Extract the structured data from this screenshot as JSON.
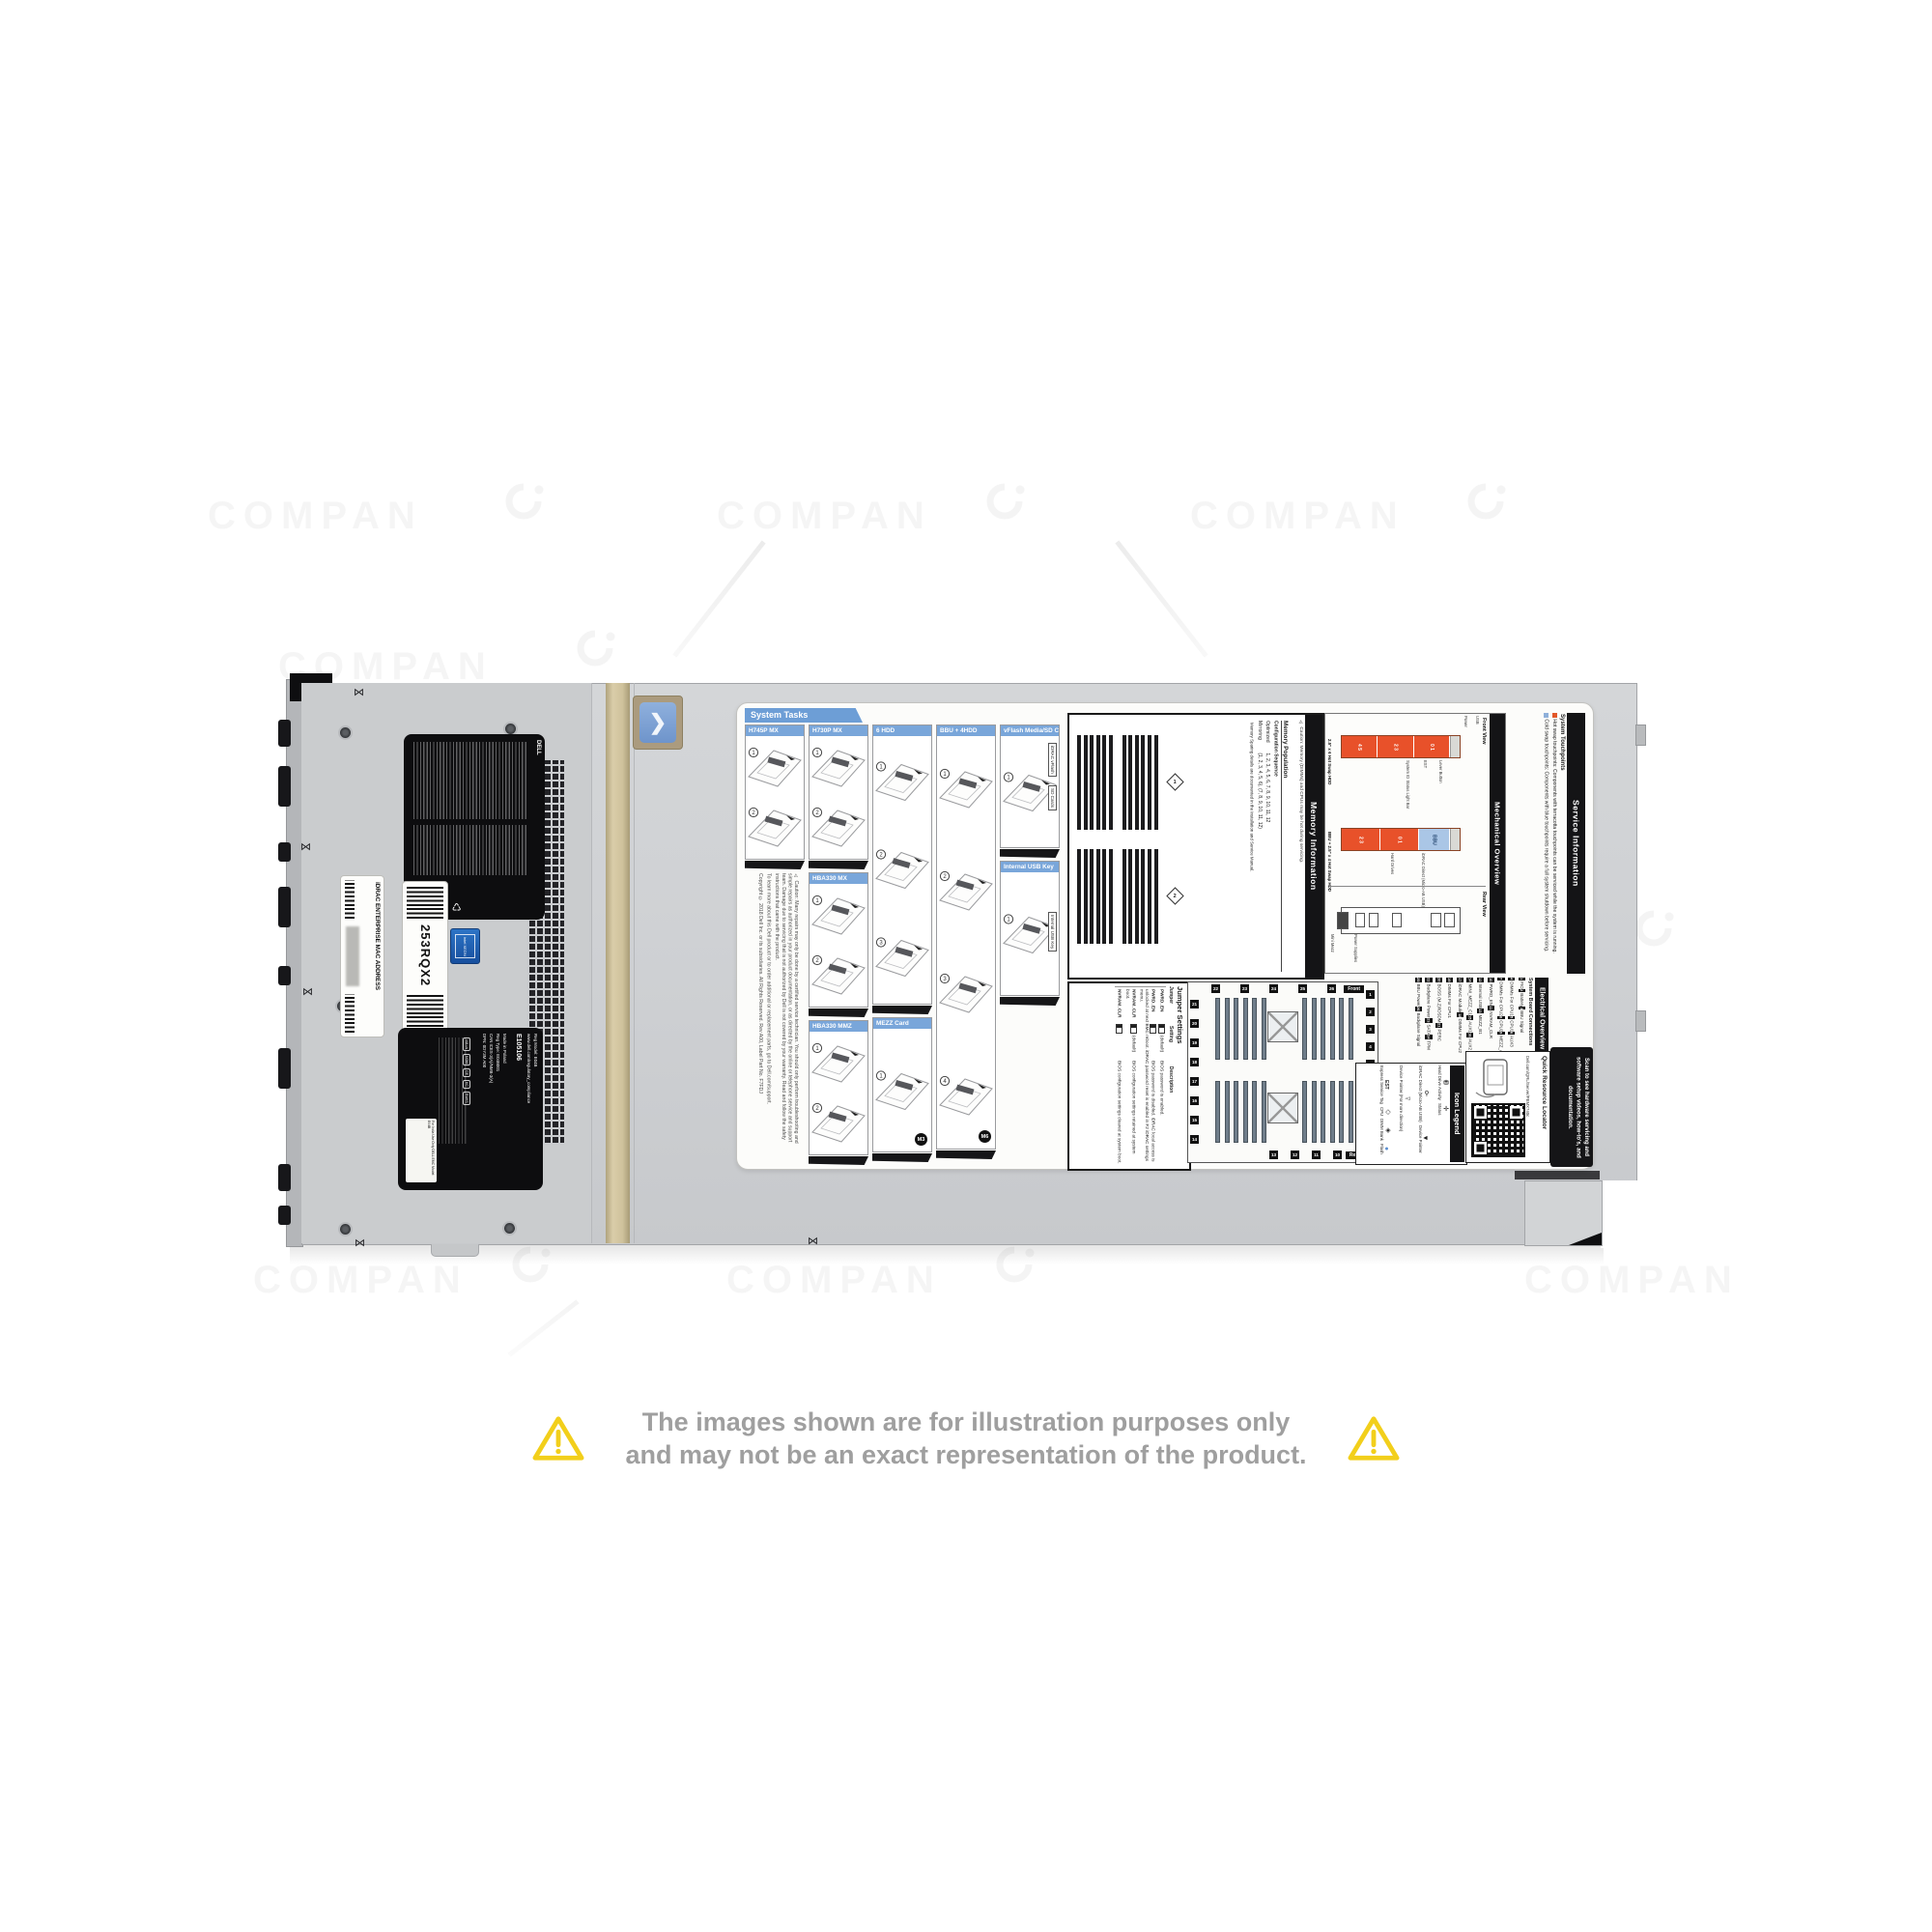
{
  "watermark": {
    "text": "COMPAN"
  },
  "disclaimer": {
    "line1": "The images shown are for illustration purposes only",
    "line2": "and may not be an exact representation of the product."
  },
  "chassis": {
    "service_tag_label": "253RQX2",
    "idrac_mac_label": "iDRAC ENTERPRISE MAC ADDRESS",
    "regulatory_label_top": {
      "brand": "DELL",
      "icons": [
        "warning-triangle",
        "weee-bin",
        "recycle"
      ]
    },
    "regulatory_label_bottom": {
      "reg_model": "Reg Model: E04B",
      "site": "www.dell.com/regulatory_compliance",
      "ul_file": "E105106",
      "made_in": "Made in Poland",
      "reg_type": "Reg Type: E04B001",
      "ices": "CAN ICES-3(A)/NMB-3(A)",
      "dpn": "DPN: 0DY3M A00",
      "india": "For India Use Only DELL EMC Model: E04B",
      "marks": [
        "cULus",
        "NOM",
        "CE",
        "KC",
        "RoHS"
      ]
    },
    "xeon_sticker": "intel XEON"
  },
  "label": {
    "system_tasks": {
      "title": "System Tasks",
      "columns": [
        {
          "panels": [
            {
              "title": "H745P MX",
              "steps": 2
            }
          ]
        },
        {
          "panels": [
            {
              "title": "H730P MX",
              "steps": 2
            },
            {
              "title": "HBA330 MX",
              "steps": 2
            },
            {
              "title": "HBA330 MMZ",
              "steps": 2
            }
          ]
        },
        {
          "panels": [
            {
              "title": "6 HDD",
              "steps": 3
            },
            {
              "title": "MEZZ Card",
              "steps": 1,
              "badge": "M3"
            }
          ]
        },
        {
          "panels": [
            {
              "title": "BBU + 4HDD",
              "steps": 4,
              "badge": "M6"
            }
          ]
        },
        {
          "panels": [
            {
              "title": "vFlash Media/SD Card",
              "steps": 1,
              "callouts": [
                "iDRAC vFlash",
                "SD Cards"
              ]
            },
            {
              "title": "Internal USB Key",
              "steps": 1,
              "callouts": [
                "Internal USB Key"
              ]
            }
          ]
        }
      ],
      "caution": "⚠ Caution: Many repairs may only be done by a certified service technician. You should only perform troubleshooting and simple repairs as authorized in your product documentation, or as directed by the online or telephone service and support team. Damage due to servicing that is not authorized by Dell is not covered by your warranty. Read and follow the safety instructions that came with the product.",
      "learn_more": "To learn more about this Dell product or to order additional or replacement parts, go to Dell.com/support.",
      "copyright": "Copyright © 2018 Dell Inc. or its subsidiaries. All Rights Reserved. Rev A00, Label Part No. F7FDJ"
    },
    "memory": {
      "title": "Memory Information",
      "caution": "⚠ Caution: Memory (DIMMs) and CPUs may be hot during servicing.",
      "population_title": "Memory Population",
      "col_configuration": "Configuration",
      "col_sequence": "Sequence",
      "rows": [
        {
          "configuration": "Optimized",
          "sequence": "1, 2, 3, 4, 5, 6, 7, 8, 9, 10, 11, 12"
        },
        {
          "configuration": "Mirroring",
          "sequence": "(1, 2, 3, 4, 5, 6), (7, 8, 9, 10, 11, 12)"
        }
      ],
      "note": "Memory Sparing details are documented in the Installation and Service Manual.",
      "banks": [
        {
          "badge": "1",
          "groups": [
            [
              "A7",
              "A1",
              "A8",
              "A2",
              "A9",
              "A3"
            ],
            [
              "B7",
              "B1",
              "B8",
              "B2",
              "B9",
              "B3"
            ]
          ]
        },
        {
          "badge": "2",
          "groups": [
            [
              "A10",
              "A4",
              "A11",
              "A5",
              "A12",
              "A6"
            ],
            [
              "B10",
              "B4",
              "B11",
              "B5",
              "B12",
              "B6"
            ]
          ]
        }
      ]
    },
    "jumper": {
      "title": "Jumper Settings",
      "headers": [
        "Jumper",
        "Setting",
        "Description"
      ],
      "rows": [
        {
          "jumper": "PWRD_EN",
          "setting": "(default)",
          "description": "BIOS password is enabled."
        },
        {
          "jumper": "PWRD_EN",
          "setting": "",
          "description": "BIOS password is disabled. iDRAC local access is unlocked at next BMC reboot. iDRAC password reset is enabled in F2 iDRAC settings menu."
        },
        {
          "jumper": "NVRAM_CLR",
          "setting": "(default)",
          "description": "BIOS configuration settings retained at system boot."
        },
        {
          "jumper": "NVRAM_CLR",
          "setting": "",
          "description": "BIOS configuration settings cleared at system boot."
        }
      ]
    },
    "electrical": {
      "title": "Electrical Overview",
      "subtitle": "System Board Connections",
      "front_tag": "Front",
      "rear_tag": "Rear",
      "connections": [
        "FIO",
        "Battery",
        "BBU Signal",
        "DIMMs For CPU1",
        "CPU1",
        "AUX3",
        "DIMMs For CPU2",
        "CPU2",
        "MEZZ_A1",
        "PWRD_EN",
        "NVRAM_CLR",
        "Internal USB",
        "MEZZ_B1",
        "MINI_MEZZ_C1",
        "AUX1",
        "AUX2",
        "iDRAC Module",
        "DIMMs For CPU2",
        "DIMMs For CPU1",
        "BOSS (M.2)/IDSDM",
        "PERC",
        "Backplane Power",
        "SATA",
        "TPM",
        "BBU Power",
        "Backplane Signal"
      ]
    },
    "mechanical": {
      "title": "Mechanical Overview",
      "front_view": {
        "title": "Front View",
        "hdd6_label": "2.5\" x 6 Hot Swap HDD",
        "hdd6_segments": [
          "4 5",
          "2 3",
          "0 1"
        ],
        "bbu4_label": "BBU + 2.5\" x 4 Hot Swap HDD",
        "bbu4_segments": [
          "2 3",
          "0 1"
        ],
        "bbu_text": "BBU",
        "callouts_top": [
          "Power",
          "USB"
        ],
        "callouts_mid": [
          "System ID Status Light Bar",
          "EST",
          "Lever Button"
        ],
        "callouts_bottom": [
          "Hard Drives",
          "iDRAC Direct (Micro-AB USB)"
        ]
      },
      "rear_view": {
        "title": "Rear View",
        "callouts": [
          "Mini Mezz",
          "Power Supplies"
        ]
      }
    },
    "service_info": {
      "title": "Service Information",
      "subtitle": "System Touchpoints",
      "hot": "Hot swap touchpoints: Components with terracotta touchpoints can be serviced while the system is running.",
      "cold": "Cold swap touchpoints: Components with blue touchpoints require a full system shutdown before servicing."
    },
    "icon_legend": {
      "title": "Icon Legend",
      "entries": [
        {
          "icon": "hard-drive-activity-icon",
          "glyph": "⛃",
          "label": "Hard Drive Activity"
        },
        {
          "icon": "status-icon",
          "glyph": "✛",
          "label": "Status"
        },
        {
          "icon": "idrac-direct-icon",
          "glyph": "⚲",
          "label": "iDRAC Direct (Micro-AB USB)"
        },
        {
          "icon": "device-pointer-icon",
          "glyph": "◄",
          "label": "Device Pointer"
        },
        {
          "icon": "device-pointer-more-icon",
          "glyph": "◅",
          "label": "Device Pointer (For more direction)"
        },
        {
          "icon": "est-icon",
          "glyph": "EST",
          "label": "Express Service Tag"
        },
        {
          "icon": "cpu-icon",
          "glyph": "◇",
          "label": "CPU"
        },
        {
          "icon": "dimm-bank-icon",
          "glyph": "◈",
          "label": "DIMM Bank"
        },
        {
          "icon": "flash-icon",
          "glyph": "●",
          "label": "Flash"
        }
      ]
    },
    "qrl": {
      "title": "Quick Resource Locator",
      "url": "Dell.com/QRL/Server/PEMX740c"
    },
    "scan_note": "Scan to see hardware servicing and software setup videos, how-to's, and documentation."
  },
  "colors": {
    "touchpoint_hot": "#e2582a",
    "touchpoint_cold": "#8fb0da",
    "drive_orange": "#e8512a",
    "bbu_blue": "#aac6e6",
    "header_blue": "#79a6da",
    "accent_yellow": "#f2cf1b"
  }
}
